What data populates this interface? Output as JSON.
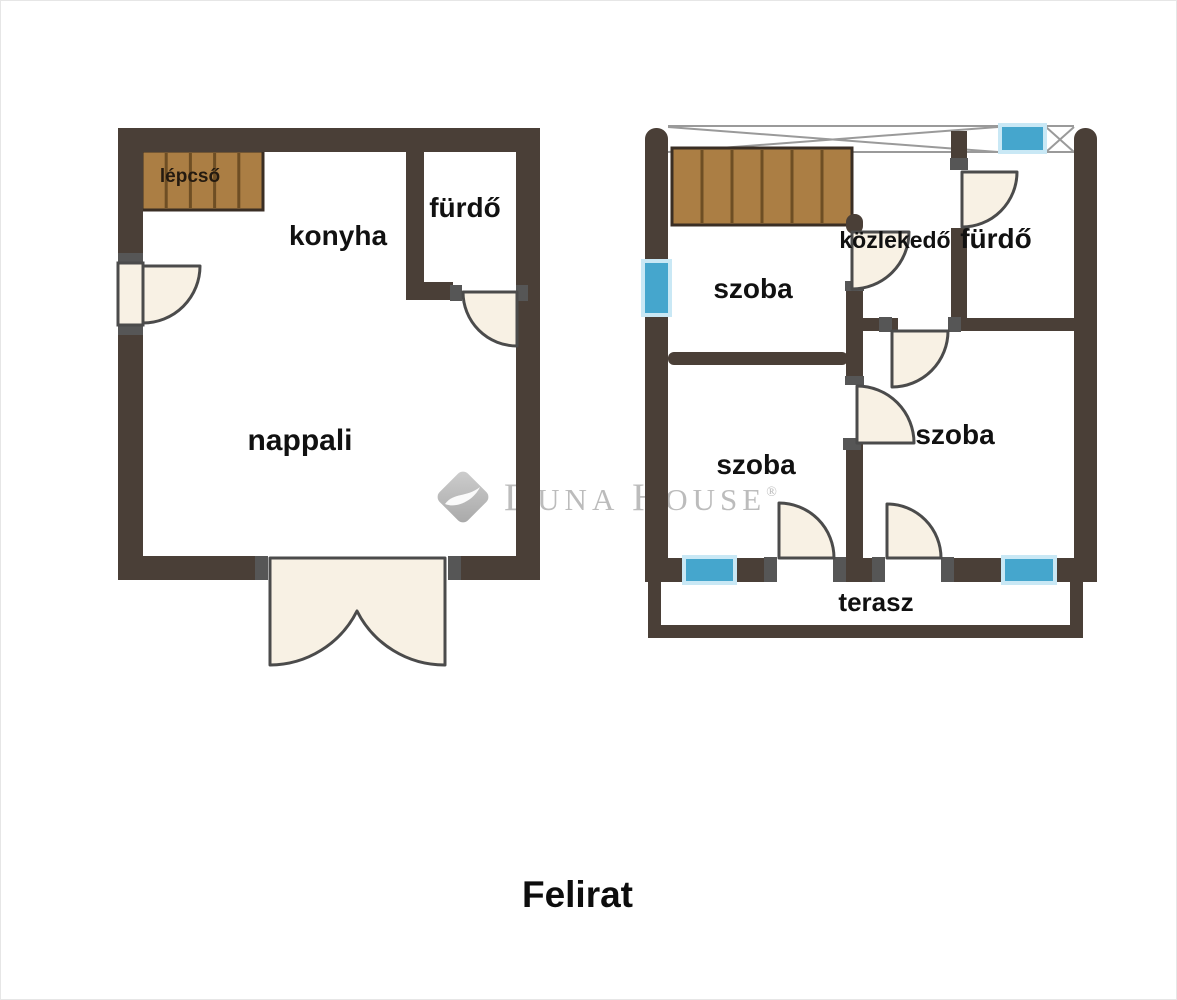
{
  "page": {
    "caption": "Felirat"
  },
  "watermark": {
    "d": "D",
    "una": "UNA",
    "h": "H",
    "ouse": "OUSE",
    "reg": "®",
    "brand": "Duna House"
  },
  "labels": {
    "lepcso": "lépcső",
    "konyha": "konyha",
    "furdo_left": "fürdő",
    "nappali": "nappali",
    "szoba_tl": "szoba",
    "kozlekedo": "közlekedő",
    "furdo_right": "fürdő",
    "szoba_bl": "szoba",
    "szoba_br": "szoba",
    "terasz": "terasz"
  },
  "colors": {
    "wall": "#4a3f37",
    "wood": "#ab7e44",
    "wood_stripe": "#6e4e24",
    "wood_outline": "#3a2e24",
    "window_glass": "#45a6cd",
    "window_frame": "#c9e8f5",
    "door_fill": "#f8f1e4",
    "door_stroke": "#4b4b4b",
    "bracket": "#565656",
    "line": "#9a9a9a",
    "text": "#111111"
  },
  "floorplan": {
    "width": 1177,
    "height": 1000,
    "lines": [
      {
        "name": "railing-top-line",
        "x1": 668,
        "y1": 126,
        "x2": 1074,
        "y2": 126
      },
      {
        "name": "railing-bottom-line",
        "x1": 852,
        "y1": 152,
        "x2": 1074,
        "y2": 152
      },
      {
        "name": "railing-cross-line",
        "x1": 668,
        "y1": 127,
        "x2": 998,
        "y2": 152
      },
      {
        "name": "railing-cross-line",
        "x1": 668,
        "y1": 152,
        "x2": 998,
        "y2": 127
      },
      {
        "name": "railing-cross-line",
        "x1": 1046,
        "y1": 127,
        "x2": 1074,
        "y2": 152
      },
      {
        "name": "railing-cross-line",
        "x1": 1046,
        "y1": 152,
        "x2": 1074,
        "y2": 127
      }
    ],
    "stairs": [
      {
        "name": "stairs-left-plan",
        "x": 142,
        "y": 151,
        "w": 121,
        "h": 59,
        "stripes": 4
      },
      {
        "name": "stairs-right-plan",
        "x": 672,
        "y": 148,
        "w": 180,
        "h": 77,
        "stripes": 5
      }
    ],
    "walls": [
      {
        "name": "lp-top-wall",
        "x": 118,
        "y": 128,
        "w": 422,
        "h": 24
      },
      {
        "name": "lp-left-wall-upper",
        "x": 118,
        "y": 128,
        "w": 25,
        "h": 135
      },
      {
        "name": "lp-left-wall-lower",
        "x": 118,
        "y": 325,
        "w": 25,
        "h": 255
      },
      {
        "name": "lp-right-wall",
        "x": 516,
        "y": 128,
        "w": 24,
        "h": 452
      },
      {
        "name": "lp-bottom-wall-left",
        "x": 118,
        "y": 556,
        "w": 137,
        "h": 24
      },
      {
        "name": "lp-bottom-wall-right",
        "x": 461,
        "y": 556,
        "w": 79,
        "h": 24
      },
      {
        "name": "lp-bath-wall-vertical",
        "x": 406,
        "y": 152,
        "w": 18,
        "h": 131
      },
      {
        "name": "lp-bath-wall-horizontal",
        "x": 406,
        "y": 282,
        "w": 47,
        "h": 18
      },
      {
        "name": "rp-left-wall-cap",
        "x": 645,
        "y": 128,
        "w": 23,
        "h": 34,
        "rx": 11
      },
      {
        "name": "rp-left-wall-upper",
        "x": 645,
        "y": 150,
        "w": 23,
        "h": 113
      },
      {
        "name": "rp-left-wall-lower",
        "x": 645,
        "y": 313,
        "w": 23,
        "h": 269
      },
      {
        "name": "rp-right-wall-cap",
        "x": 1074,
        "y": 128,
        "w": 23,
        "h": 34,
        "rx": 11
      },
      {
        "name": "rp-right-wall",
        "x": 1074,
        "y": 150,
        "w": 23,
        "h": 432
      },
      {
        "name": "rp-bottom-wall",
        "x": 645,
        "y": 558,
        "w": 41,
        "h": 24
      },
      {
        "name": "rp-bottom-wall",
        "x": 733,
        "y": 558,
        "w": 31,
        "h": 24
      },
      {
        "name": "rp-bottom-wall",
        "x": 846,
        "y": 558,
        "w": 26,
        "h": 24
      },
      {
        "name": "rp-bottom-wall",
        "x": 954,
        "y": 558,
        "w": 51,
        "h": 24
      },
      {
        "name": "rp-bottom-wall",
        "x": 1053,
        "y": 558,
        "w": 44,
        "h": 24
      },
      {
        "name": "rp-center-wall-cap",
        "x": 846,
        "y": 214,
        "w": 17,
        "h": 20,
        "rx": 8
      },
      {
        "name": "rp-center-wall-mid",
        "x": 846,
        "y": 288,
        "w": 17,
        "h": 92
      },
      {
        "name": "rp-center-wall-low",
        "x": 846,
        "y": 443,
        "w": 17,
        "h": 115
      },
      {
        "name": "rp-hall-wall-upper",
        "x": 951,
        "y": 131,
        "w": 16,
        "h": 39
      },
      {
        "name": "rp-hall-wall-mid",
        "x": 951,
        "y": 228,
        "w": 16,
        "h": 103
      },
      {
        "name": "rp-hall-bottom-wall-left",
        "x": 846,
        "y": 318,
        "w": 52,
        "h": 13
      },
      {
        "name": "rp-hall-bottom-wall-right",
        "x": 950,
        "y": 318,
        "w": 124,
        "h": 13
      },
      {
        "name": "rp-room-divider-wall",
        "x": 668,
        "y": 352,
        "w": 180,
        "h": 13,
        "rx": 6
      },
      {
        "name": "terrace-wall-left",
        "x": 648,
        "y": 582,
        "w": 13,
        "h": 56
      },
      {
        "name": "terrace-wall-bottom",
        "x": 648,
        "y": 625,
        "w": 435,
        "h": 13
      },
      {
        "name": "terrace-wall-right",
        "x": 1070,
        "y": 582,
        "w": 13,
        "h": 56
      }
    ],
    "windows": [
      {
        "name": "window-left-wall",
        "x": 645,
        "y": 263,
        "w": 23,
        "h": 50
      },
      {
        "name": "window-top-railing",
        "x": 1002,
        "y": 127,
        "w": 41,
        "h": 23
      },
      {
        "name": "window-bottom-left",
        "x": 686,
        "y": 559,
        "w": 47,
        "h": 22
      },
      {
        "name": "window-bottom-right",
        "x": 1005,
        "y": 559,
        "w": 48,
        "h": 22
      }
    ],
    "brackets": [
      {
        "name": "door-frame-bracket",
        "x": 118,
        "y": 253,
        "w": 25,
        "h": 9
      },
      {
        "name": "door-frame-bracket",
        "x": 118,
        "y": 326,
        "w": 25,
        "h": 9
      },
      {
        "name": "door-frame-bracket",
        "x": 450,
        "y": 285,
        "w": 12,
        "h": 16
      },
      {
        "name": "door-frame-bracket",
        "x": 516,
        "y": 285,
        "w": 12,
        "h": 16
      },
      {
        "name": "door-frame-bracket",
        "x": 255,
        "y": 556,
        "w": 13,
        "h": 24
      },
      {
        "name": "door-frame-bracket",
        "x": 448,
        "y": 556,
        "w": 13,
        "h": 24
      },
      {
        "name": "door-frame-bracket",
        "x": 845,
        "y": 281,
        "w": 19,
        "h": 10
      },
      {
        "name": "door-frame-bracket",
        "x": 845,
        "y": 376,
        "w": 19,
        "h": 9
      },
      {
        "name": "door-frame-bracket",
        "x": 843,
        "y": 438,
        "w": 18,
        "h": 12
      },
      {
        "name": "door-frame-bracket",
        "x": 950,
        "y": 158,
        "w": 18,
        "h": 12
      },
      {
        "name": "door-frame-bracket",
        "x": 879,
        "y": 317,
        "w": 13,
        "h": 15
      },
      {
        "name": "door-frame-bracket",
        "x": 948,
        "y": 317,
        "w": 13,
        "h": 15
      },
      {
        "name": "door-frame-bracket",
        "x": 764,
        "y": 557,
        "w": 13,
        "h": 25
      },
      {
        "name": "door-frame-bracket",
        "x": 833,
        "y": 557,
        "w": 13,
        "h": 25
      },
      {
        "name": "door-frame-bracket",
        "x": 872,
        "y": 557,
        "w": 13,
        "h": 25
      },
      {
        "name": "door-frame-bracket",
        "x": 941,
        "y": 557,
        "w": 13,
        "h": 25
      }
    ],
    "door_leafs": [
      {
        "name": "entry-door-leaf",
        "x": 118,
        "y": 263,
        "w": 25,
        "h": 62
      }
    ],
    "doors": [
      {
        "name": "entry-door-swing",
        "d": "M143,266 L200,266 A57,57 0 0 1 143,323 Z"
      },
      {
        "name": "lp-bathroom-door-swing",
        "d": "M517,292 L463,292 A54,54 0 0 0 517,346 Z"
      },
      {
        "name": "double-terrace-door-swing",
        "d": "M270,558 L270,665 A98,98 0 0 0 357,611 A98,98 0 0 0 445,665 L445,558 Z"
      },
      {
        "name": "rp-room-door-swing-top",
        "d": "M852,232 L909,232 A57,57 0 0 1 852,289 Z"
      },
      {
        "name": "rp-room-door-swing-mid",
        "d": "M857,443 L857,386 A57,57 0 0 1 914,443 Z"
      },
      {
        "name": "rp-bathroom-door-swing",
        "d": "M962,172 L962,227 A55,55 0 0 0 1017,172 Z"
      },
      {
        "name": "rp-hall-door-swing",
        "d": "M892,331 L948,331 A56,56 0 0 1 892,387 Z"
      },
      {
        "name": "rp-terrace-door-swing-left",
        "d": "M779,558 L779,503 A55,55 0 0 1 834,558 Z"
      },
      {
        "name": "rp-terrace-door-swing-right",
        "d": "M887,558 L887,504 A54,54 0 0 1 941,558 Z"
      }
    ],
    "texts": [
      {
        "name": "room-label-lepcso",
        "key": "lepcso",
        "x": 190,
        "y": 182,
        "size": 19,
        "color": "#241a10"
      },
      {
        "name": "room-label-konyha",
        "key": "konyha",
        "x": 338,
        "y": 245,
        "size": 28
      },
      {
        "name": "room-label-furdo-left",
        "key": "furdo_left",
        "x": 465,
        "y": 217,
        "size": 28
      },
      {
        "name": "room-label-nappali",
        "key": "nappali",
        "x": 300,
        "y": 450,
        "size": 30
      },
      {
        "name": "room-label-szoba-top-left",
        "key": "szoba_tl",
        "x": 753,
        "y": 298,
        "size": 28
      },
      {
        "name": "room-label-kozlekedo",
        "key": "kozlekedo",
        "x": 895,
        "y": 248,
        "size": 23
      },
      {
        "name": "room-label-furdo-right",
        "key": "furdo_right",
        "x": 996,
        "y": 248,
        "size": 28
      },
      {
        "name": "room-label-szoba-bottom-left",
        "key": "szoba_bl",
        "x": 756,
        "y": 474,
        "size": 28
      },
      {
        "name": "room-label-szoba-bottom-right",
        "key": "szoba_br",
        "x": 955,
        "y": 444,
        "size": 28
      },
      {
        "name": "room-label-terasz",
        "key": "terasz",
        "x": 876,
        "y": 611,
        "size": 26
      }
    ]
  }
}
